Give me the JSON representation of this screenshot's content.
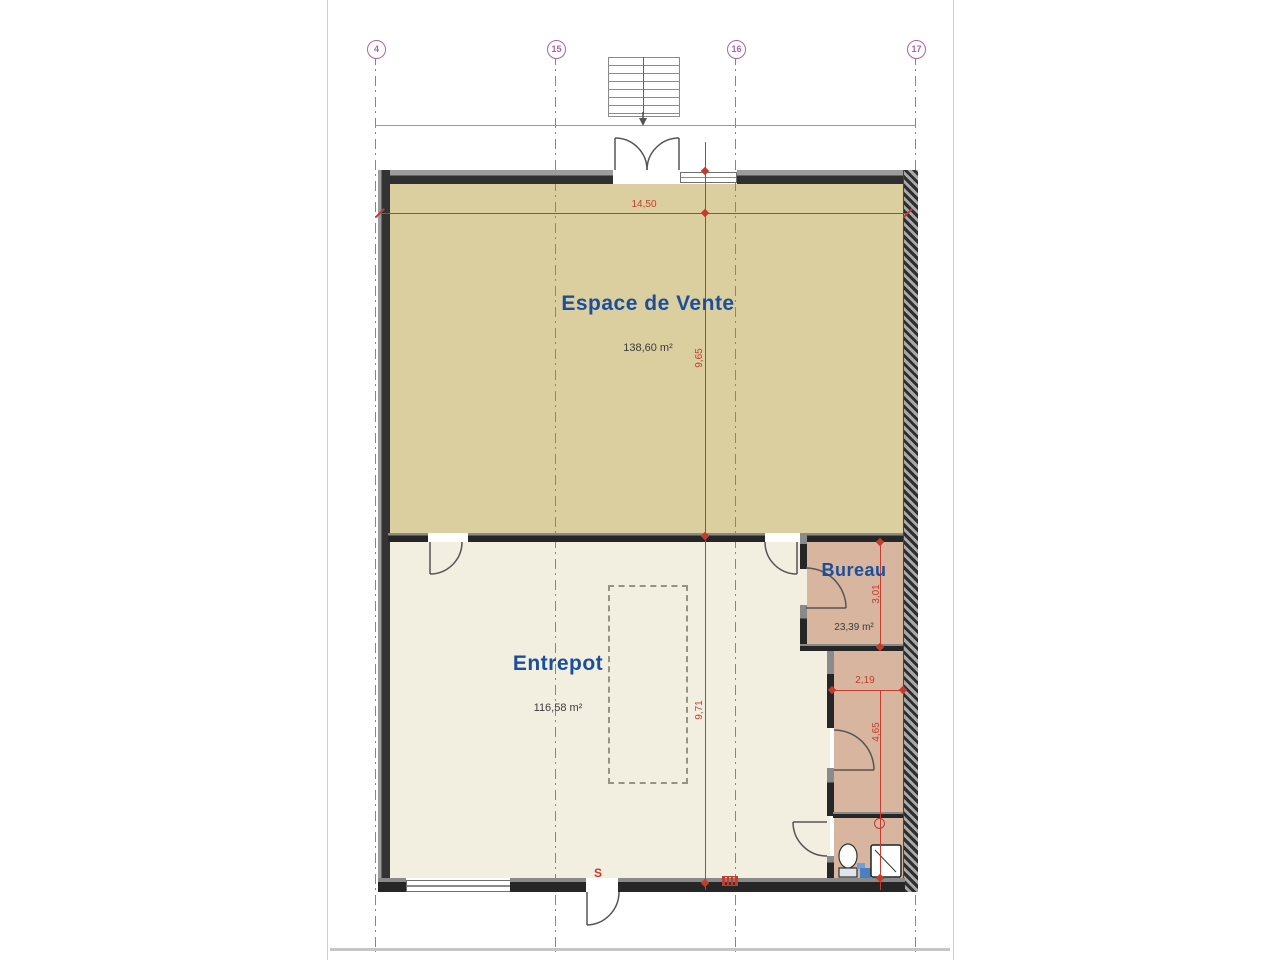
{
  "plan_title": "floor-plan",
  "grid": {
    "labels": [
      "4",
      "15",
      "16",
      "17"
    ]
  },
  "rooms": {
    "sales": {
      "name": "Espace de Vente",
      "area": "138,60 m²"
    },
    "warehouse": {
      "name": "Entrepot",
      "area": "116,58 m²"
    },
    "office": {
      "name": "Bureau",
      "area": "23,39 m²"
    }
  },
  "dimensions": {
    "overall_width": "14,50",
    "sales_depth": "9,65",
    "warehouse_depth": "9,71",
    "office_depth": "3,01",
    "hall_width": "2,19",
    "hall_depth": "4,65"
  },
  "annotations": {
    "exit": "S"
  },
  "colors": {
    "sales_fill": "#dbcf9f",
    "warehouse_fill": "#f2eee0",
    "office_fill": "#d7b59f",
    "wall": "#303030",
    "dimension_red": "#c43c2e",
    "label_blue": "#1b4e9b",
    "grid_purple": "#a864a8"
  }
}
